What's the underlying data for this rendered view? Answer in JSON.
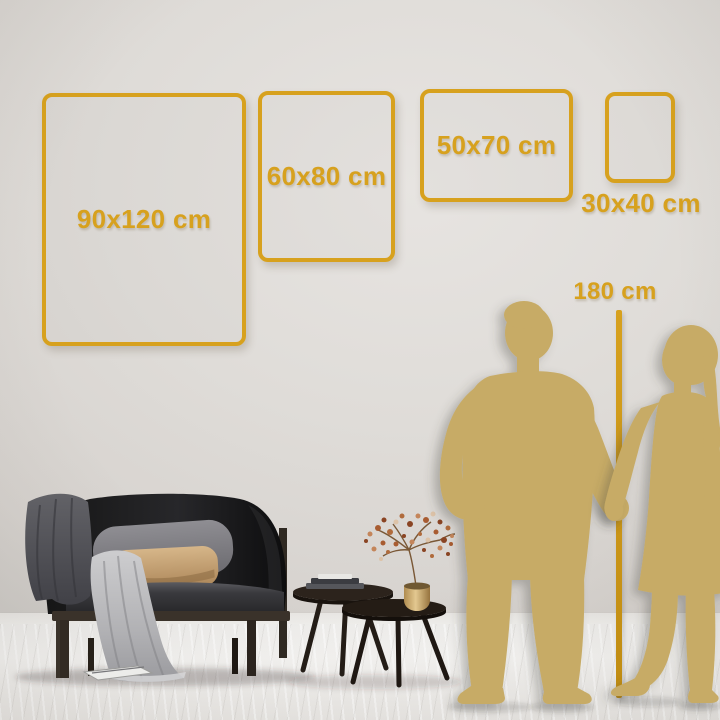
{
  "colors": {
    "gold": "#d7a11e",
    "gold_deep": "#c08c12",
    "silhouette": "#c7ab66",
    "wall": "#ddd9d5",
    "floor": "#f2f1ee"
  },
  "frames": [
    {
      "label": "90x120 cm"
    },
    {
      "label": "60x80 cm"
    },
    {
      "label": "50x70 cm"
    },
    {
      "label": "30x40 cm"
    }
  ],
  "ruler": {
    "label": "180 cm"
  }
}
